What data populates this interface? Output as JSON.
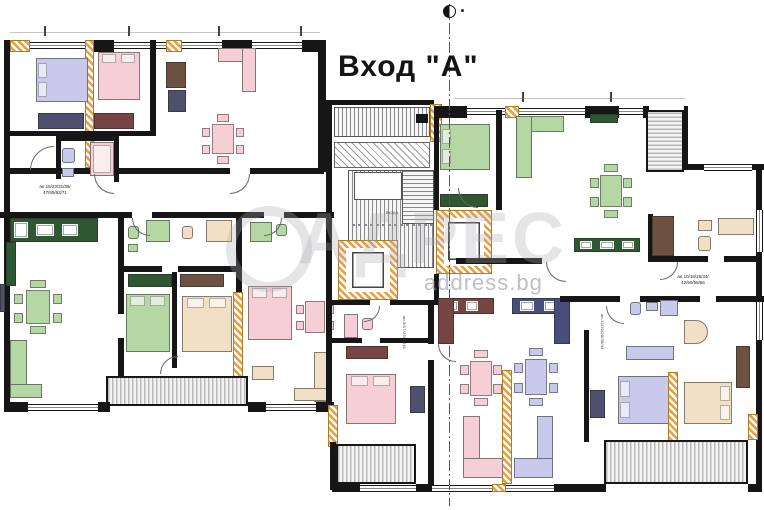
{
  "title": "Вход \"А\"",
  "watermark": {
    "logo": "АДРЕС",
    "site": "address.bg"
  },
  "labels": {
    "apt_left": "ап.15/23/31/39/\n47/55/63/71",
    "apt_right": "ап.10/18/26/34/\n42/50/58/66",
    "apt_v1": "ап.9/17/25/33/41",
    "apt_v2": "ап.12/20/28/36/44",
    "stair": "входа"
  },
  "colors": {
    "wall": "#161616",
    "hatch": "#eb9d3e",
    "balcony": "#b9b9b9",
    "lavender": "#c9c9ec",
    "pink": "#f6cfd6",
    "green": "#b4d7a4",
    "darkgreen": "#2f5731",
    "beige": "#f2e0c6",
    "maroon": "#774444",
    "navy": "#4a4c7c",
    "brown": "#6e5140",
    "slate": "#50506e",
    "watermark": "#a8a8b2"
  }
}
